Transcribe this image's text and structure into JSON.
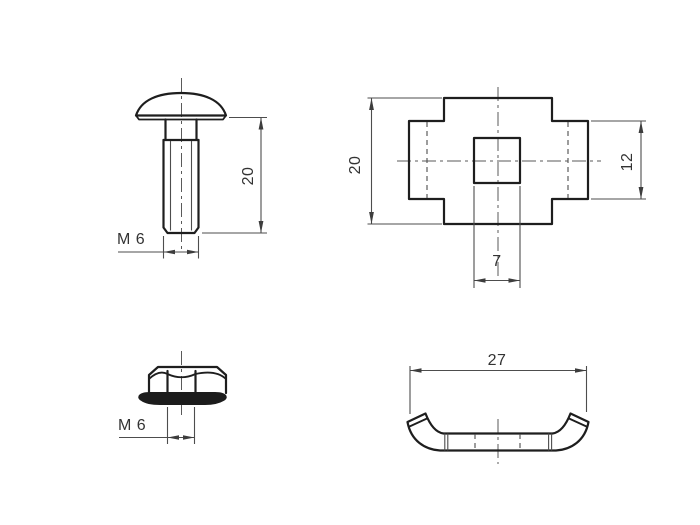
{
  "colors": {
    "background": "#ffffff",
    "object_line": "#1e1e1e",
    "dimension_line": "#4d4d4d",
    "text": "#333333"
  },
  "views": {
    "bolt": {
      "length_label": "20",
      "thread_label": "M 6"
    },
    "plate": {
      "height_label": "20",
      "side_height_label": "12",
      "slot_width_label": "7"
    },
    "flange_nut": {
      "thread_label": "M 6"
    },
    "clip": {
      "width_label": "27"
    }
  }
}
